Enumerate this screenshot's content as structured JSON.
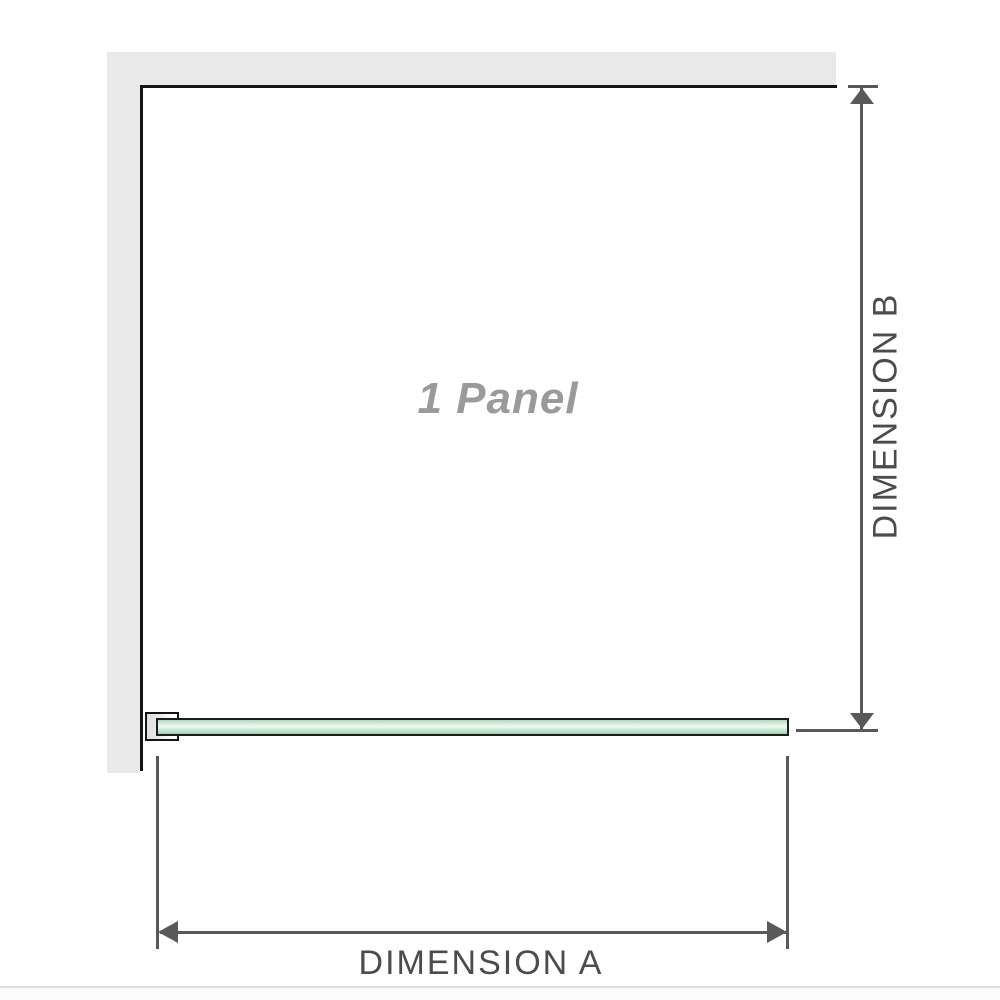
{
  "diagram": {
    "panel_label": "1 Panel",
    "dimension_a_label": "DIMENSION A",
    "dimension_b_label": "DIMENSION B"
  },
  "colors": {
    "wall_fill": "#e9e9e9",
    "wall_edge": "#141414",
    "glass_border": "#1c1c1c",
    "glass_green": "#b9e0c6",
    "glass_green_light": "#e9f6ec",
    "glass_green_dark": "#9ccdaf",
    "bracket_fill": "#dfdfdf",
    "dimension_line": "#58595b",
    "dimension_text": "#4c4c4c",
    "panel_label_text": "#9a9a9a",
    "baseline_rule": "#dcdcdc"
  }
}
